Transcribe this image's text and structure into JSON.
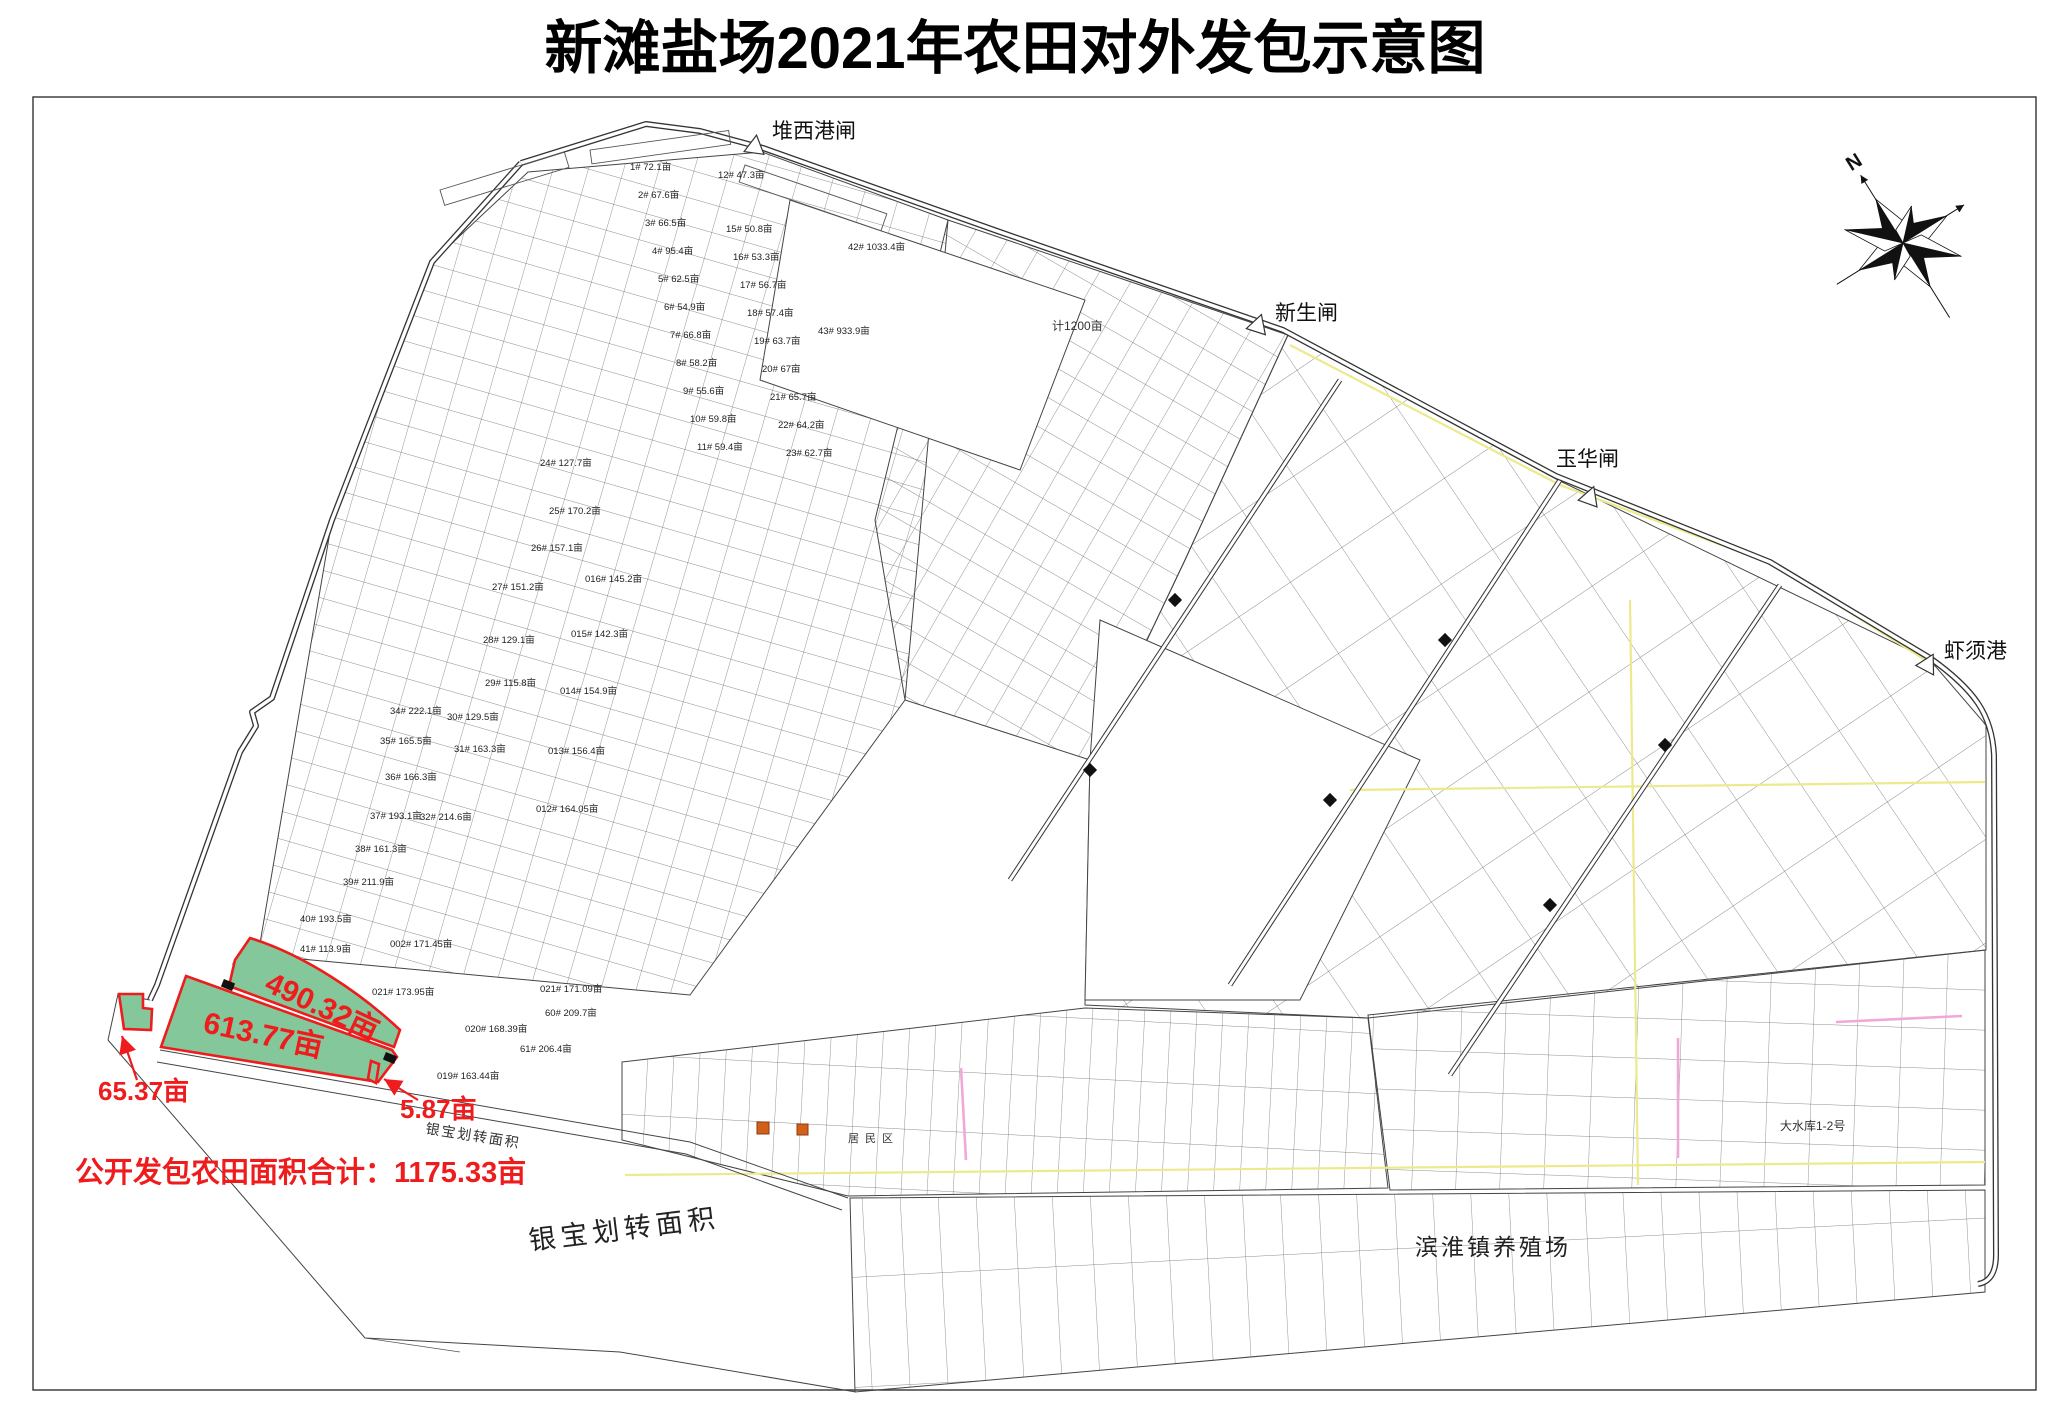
{
  "title": "新滩盐场2021年农田对外发包示意图",
  "compass": {
    "north_label": "N"
  },
  "gates": [
    {
      "name": "堆西港闸"
    },
    {
      "name": "新生闸"
    },
    {
      "name": "玉华闸"
    },
    {
      "name": "虾须港"
    }
  ],
  "highlighted_parcels": [
    {
      "area_label": "490.32亩"
    },
    {
      "area_label": "613.77亩"
    },
    {
      "area_label": "65.37亩"
    },
    {
      "area_label": "5.87亩"
    }
  ],
  "summary_text": "公开发包农田面积合计：1175.33亩",
  "region_labels": [
    {
      "text": "银宝划转面积"
    },
    {
      "text": "银宝划转面积"
    },
    {
      "text": "滨淮镇养殖场"
    },
    {
      "text": "居民区"
    },
    {
      "text": "大水库1-2号"
    },
    {
      "text": "计1200亩"
    }
  ],
  "parcel_labels": [
    {
      "text": "1# 72.1亩"
    },
    {
      "text": "2# 67.6亩"
    },
    {
      "text": "3# 66.5亩"
    },
    {
      "text": "4# 95.4亩"
    },
    {
      "text": "5# 62.5亩"
    },
    {
      "text": "6# 54.9亩"
    },
    {
      "text": "7# 66.8亩"
    },
    {
      "text": "8# 58.2亩"
    },
    {
      "text": "9# 55.6亩"
    },
    {
      "text": "10# 59.8亩"
    },
    {
      "text": "11# 59.4亩"
    },
    {
      "text": "12# 47.3亩"
    },
    {
      "text": "15# 50.8亩"
    },
    {
      "text": "16# 53.3亩"
    },
    {
      "text": "17# 56.7亩"
    },
    {
      "text": "18# 57.4亩"
    },
    {
      "text": "19# 63.7亩"
    },
    {
      "text": "20# 67亩"
    },
    {
      "text": "21# 65.7亩"
    },
    {
      "text": "22# 64.2亩"
    },
    {
      "text": "23# 62.7亩"
    },
    {
      "text": "24# 127.7亩"
    },
    {
      "text": "25# 170.2亩"
    },
    {
      "text": "26# 157.1亩"
    },
    {
      "text": "27# 151.2亩"
    },
    {
      "text": "28# 129.1亩"
    },
    {
      "text": "29# 115.8亩"
    },
    {
      "text": "30# 129.5亩"
    },
    {
      "text": "31# 163.3亩"
    },
    {
      "text": "32# 214.6亩"
    },
    {
      "text": "34# 222.1亩"
    },
    {
      "text": "35# 165.5亩"
    },
    {
      "text": "36# 166.3亩"
    },
    {
      "text": "37# 193.1亩"
    },
    {
      "text": "38# 161.3亩"
    },
    {
      "text": "39# 211.9亩"
    },
    {
      "text": "40# 193.5亩"
    },
    {
      "text": "41# 113.9亩"
    },
    {
      "text": "42# 1033.4亩"
    },
    {
      "text": "43# 933.9亩"
    },
    {
      "text": "016# 145.2亩"
    },
    {
      "text": "015# 142.3亩"
    },
    {
      "text": "014# 154.9亩"
    },
    {
      "text": "013# 156.4亩"
    },
    {
      "text": "012# 164.05亩"
    },
    {
      "text": "002# 171.45亩"
    },
    {
      "text": "021# 173.95亩"
    },
    {
      "text": "019# 163.44亩"
    },
    {
      "text": "020# 168.39亩"
    },
    {
      "text": "021# 171.09亩"
    },
    {
      "text": "60# 209.7亩"
    },
    {
      "text": "61# 206.4亩"
    }
  ],
  "colors": {
    "highlight_green": "#84c79a",
    "annotation_red": "#ee1c1c",
    "boundary_yellow": "#ecea8c",
    "road_pink": "#efa8d8"
  }
}
